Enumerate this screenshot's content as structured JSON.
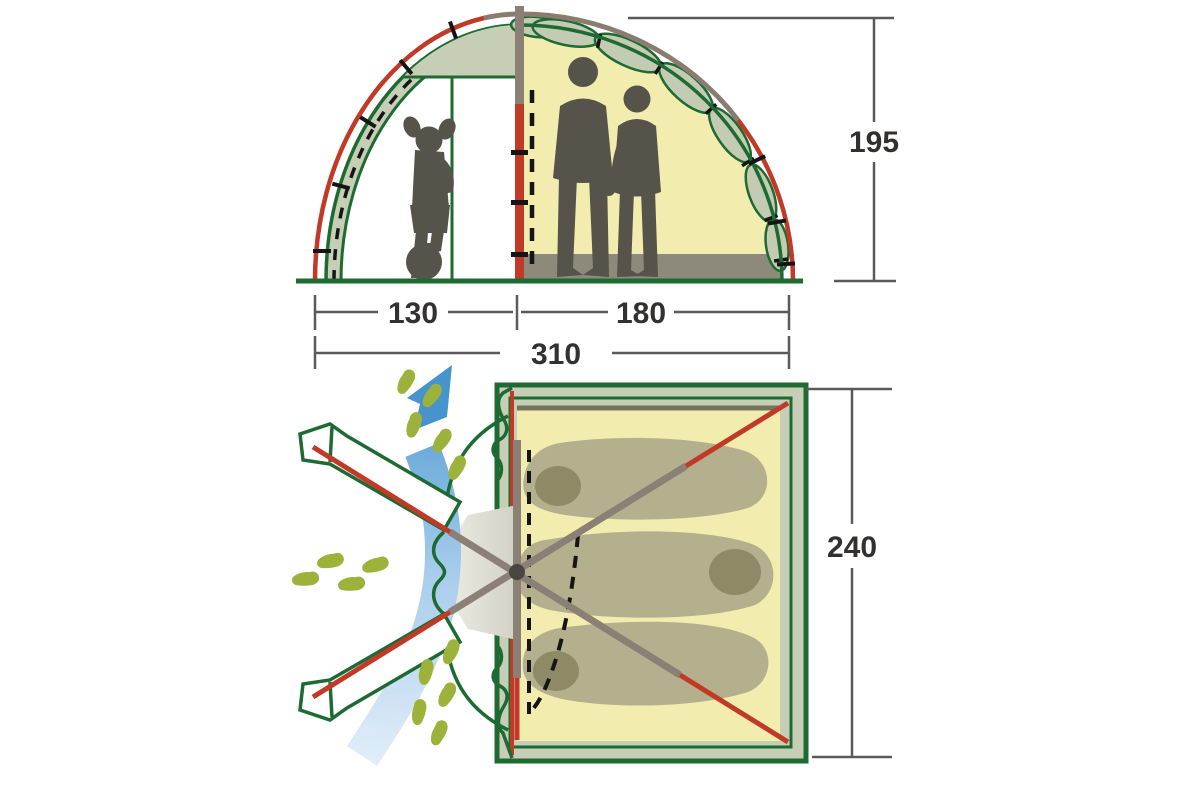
{
  "diagram": {
    "type": "tent-dimensions-diagram",
    "views": {
      "cross_section": {
        "name": "cross-section (front elevation)",
        "height": "195",
        "vestibule_width": "130",
        "sleeping_width": "180",
        "total_width": "310",
        "figures": [
          "child-with-ball-silhouette",
          "man-silhouette",
          "woman-silhouette"
        ]
      },
      "floor_plan": {
        "name": "floor plan (top view)",
        "depth": "240",
        "sleeping_bags_count": 3
      }
    },
    "icons": {
      "airflow_arrow": "curved-up-arrow",
      "footprints": "walking-footprint-trail",
      "tent_poles": "crossed-pole-lines",
      "door_zipper": "dashed-line"
    },
    "colors": {
      "outline_green": "#1d6a33",
      "fabric_sage": "#c6cfb5",
      "interior_yellow": "#f2edae",
      "pole_red": "#c13a27",
      "pole_gray": "#8b8076",
      "apex_gray_brown": "#8a7d70",
      "floor_gray": "#8d8a7c",
      "silhouette": "#55534a",
      "sleeping_bag": "#b4b08d",
      "sleeping_bag_hood": "#8e8a66",
      "airflow_blue": "#4e9ad3",
      "footprint_green": "#9db23a",
      "dimension_line": "#5a5a5a",
      "dimension_text": "#333130"
    }
  }
}
